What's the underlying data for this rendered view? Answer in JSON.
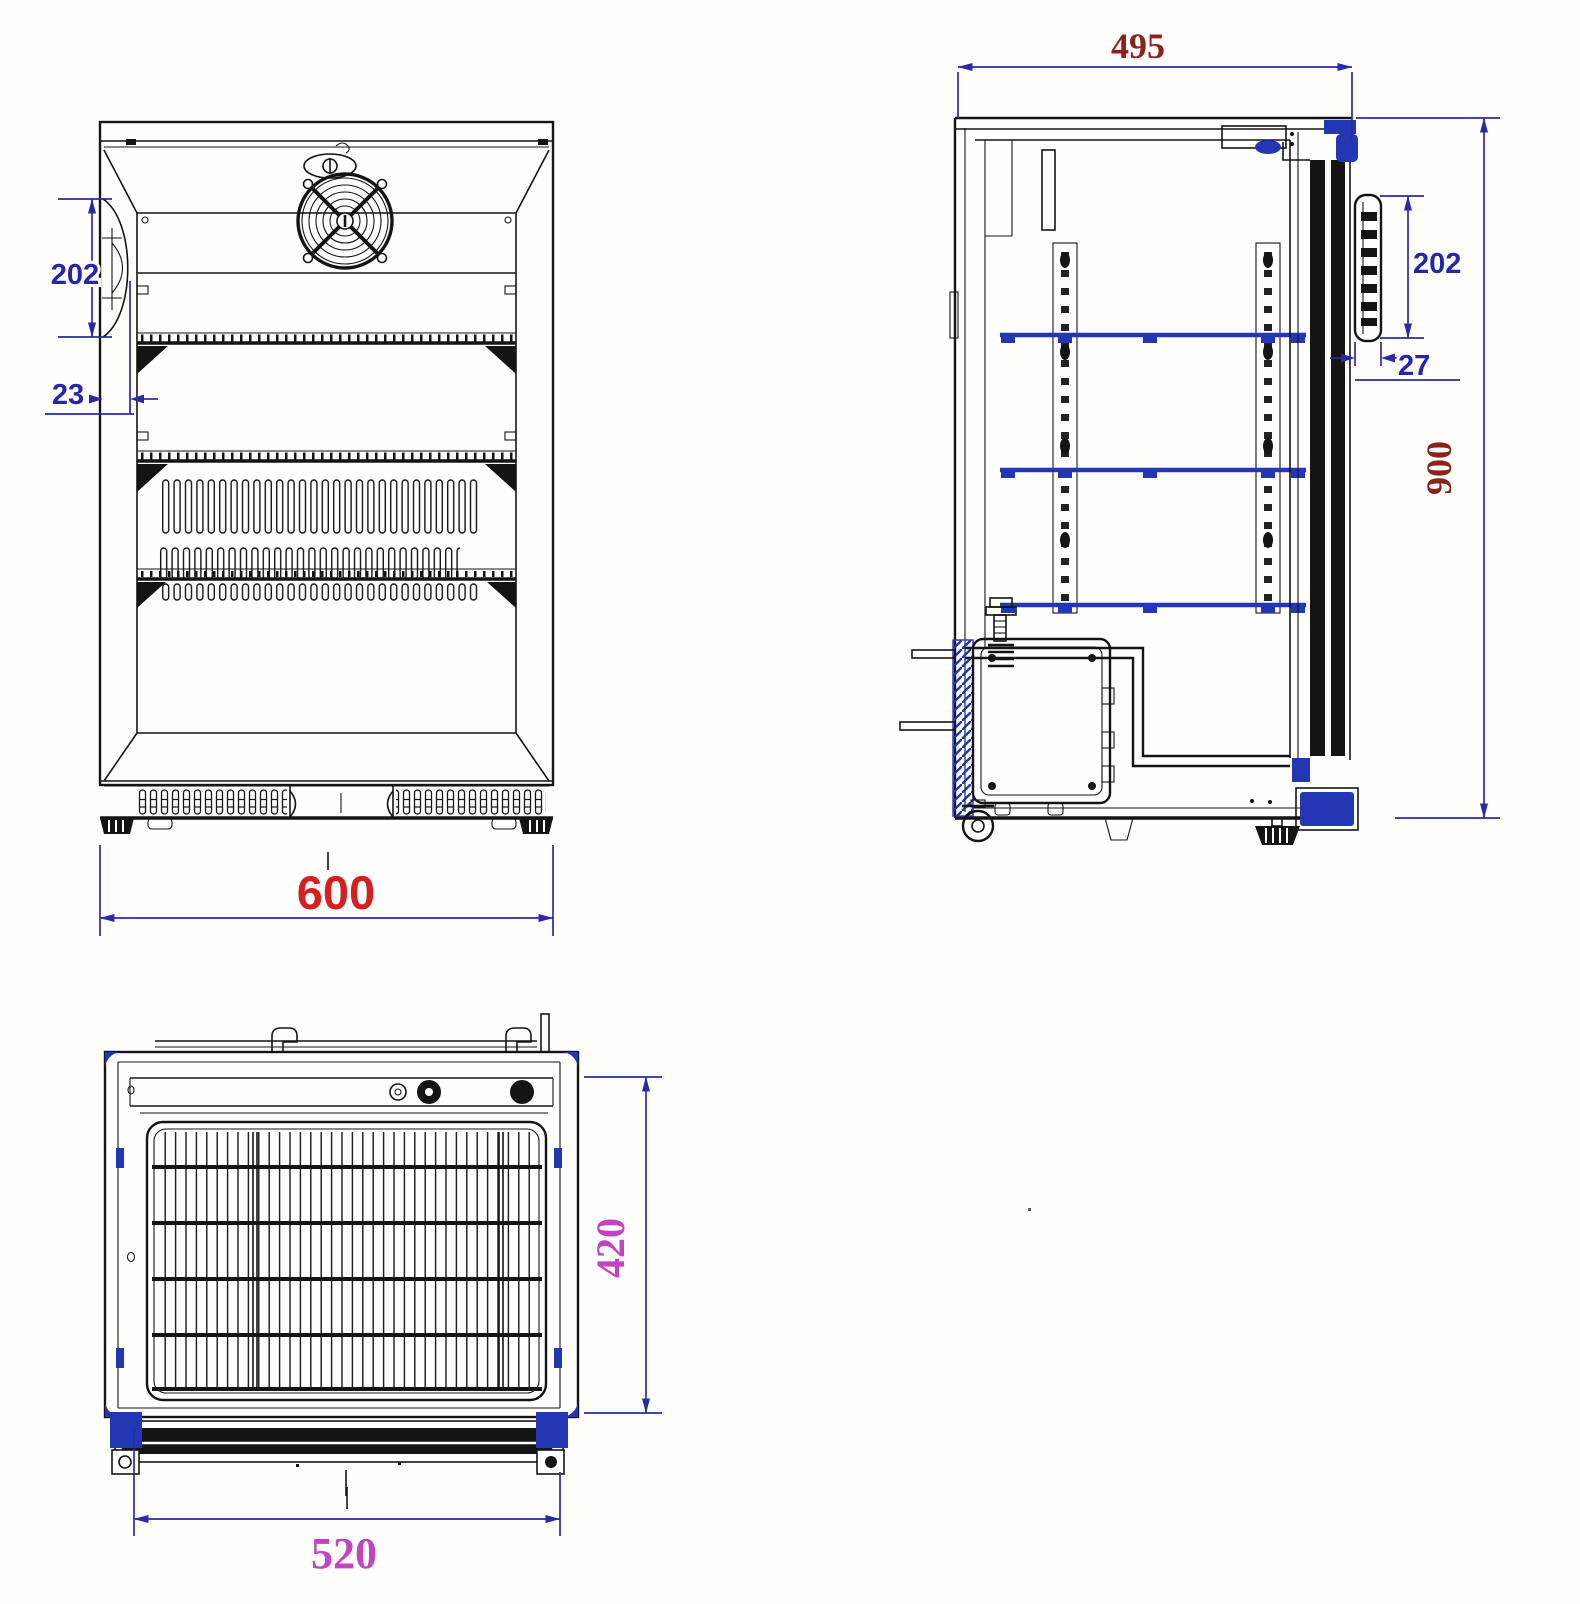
{
  "drawing": {
    "type": "technical-drawing-three-views",
    "views": {
      "front": {
        "dimensions": {
          "overall_width": "600",
          "handle_height": "202",
          "handle_depth": "23"
        }
      },
      "side": {
        "dimensions": {
          "overall_depth": "495",
          "overall_height": "900",
          "handle_height": "202",
          "handle_depth": "27"
        }
      },
      "top": {
        "dimensions": {
          "body_depth": "420",
          "door_width": "520"
        }
      }
    },
    "colors": {
      "label_red": "#d61f1f",
      "label_blue": "#2525ad",
      "label_dark_red": "#8c231a",
      "label_magenta": "#c343c3",
      "dimension_line_blue": "#2a2aa6",
      "part_blue": "#2336b4",
      "line_black": "#141414"
    }
  }
}
